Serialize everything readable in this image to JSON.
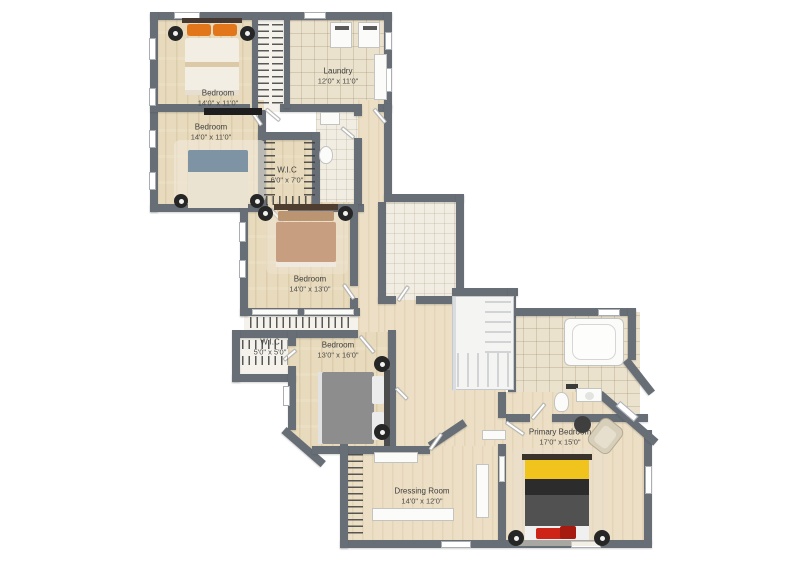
{
  "plan": {
    "type": "floor-plan",
    "palette": {
      "wall": "#676e76",
      "wood_floor": "#e8dabc",
      "tile_floor": "#ebe2cd",
      "bed1_accent": "#e2761b",
      "bed2_accent": "#7e94a5",
      "bed3_accent": "#c79e80",
      "bed4_accent": "#8d8d8d",
      "primary_bed_yellow": "#f1c41d",
      "primary_bed_black": "#2c2c2c",
      "primary_bed_red": "#ce2417"
    },
    "rooms": [
      {
        "id": "bedroom-1",
        "name": "Bedroom",
        "dims": "14'0\" x 11'0\""
      },
      {
        "id": "bedroom-2",
        "name": "Bedroom",
        "dims": "14'0\" x 11'0\""
      },
      {
        "id": "laundry",
        "name": "Laundry",
        "dims": "12'0\" x 11'0\""
      },
      {
        "id": "wic-1",
        "name": "W.I.C",
        "dims": "6'0\" x 7'0\""
      },
      {
        "id": "bedroom-3",
        "name": "Bedroom",
        "dims": "14'0\" x 13'0\""
      },
      {
        "id": "wic-2",
        "name": "W.I.C",
        "dims": "5'0\" x 5'0\""
      },
      {
        "id": "bedroom-4",
        "name": "Bedroom",
        "dims": "13'0\" x 16'0\""
      },
      {
        "id": "dressing-room",
        "name": "Dressing Room",
        "dims": "14'0\" x 12'0\""
      },
      {
        "id": "primary-bedroom",
        "name": "Primary Bedroom",
        "dims": "17'0\" x 15'0\""
      }
    ]
  }
}
